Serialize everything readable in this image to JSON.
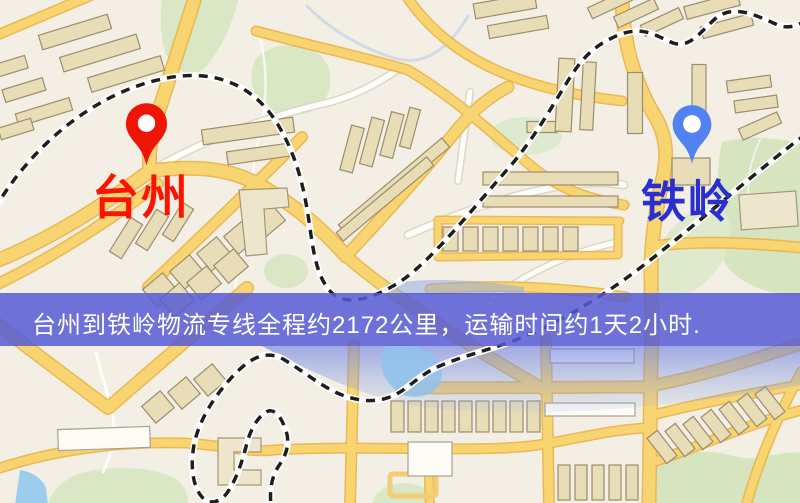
{
  "banner": {
    "text": "台州到铁岭物流专线全程约2172公里，运输时间约1天2小时.",
    "background_color": "#565ad5",
    "text_color": "#ffffff"
  },
  "markers": {
    "origin": {
      "label": "台州",
      "pin_color": "#ee1506",
      "label_color": "#fe1200"
    },
    "destination": {
      "label": "铁岭",
      "pin_color": "#5282f0",
      "label_color": "#2a2fd0"
    }
  },
  "route": {
    "distance_text": "2172公里",
    "duration_text": "1天2小时"
  },
  "map_palette": {
    "background": "#f3efe4",
    "road_fill": "#f9d572",
    "road_casing": "#e9b44c",
    "minor_road": "#fdfdfa",
    "building_fill": "#e8ddb6",
    "building_stroke": "#9c8d6d",
    "green_area": "#d9e7c5",
    "water": "#8fc2ec",
    "railway": "#1e1e1e"
  }
}
